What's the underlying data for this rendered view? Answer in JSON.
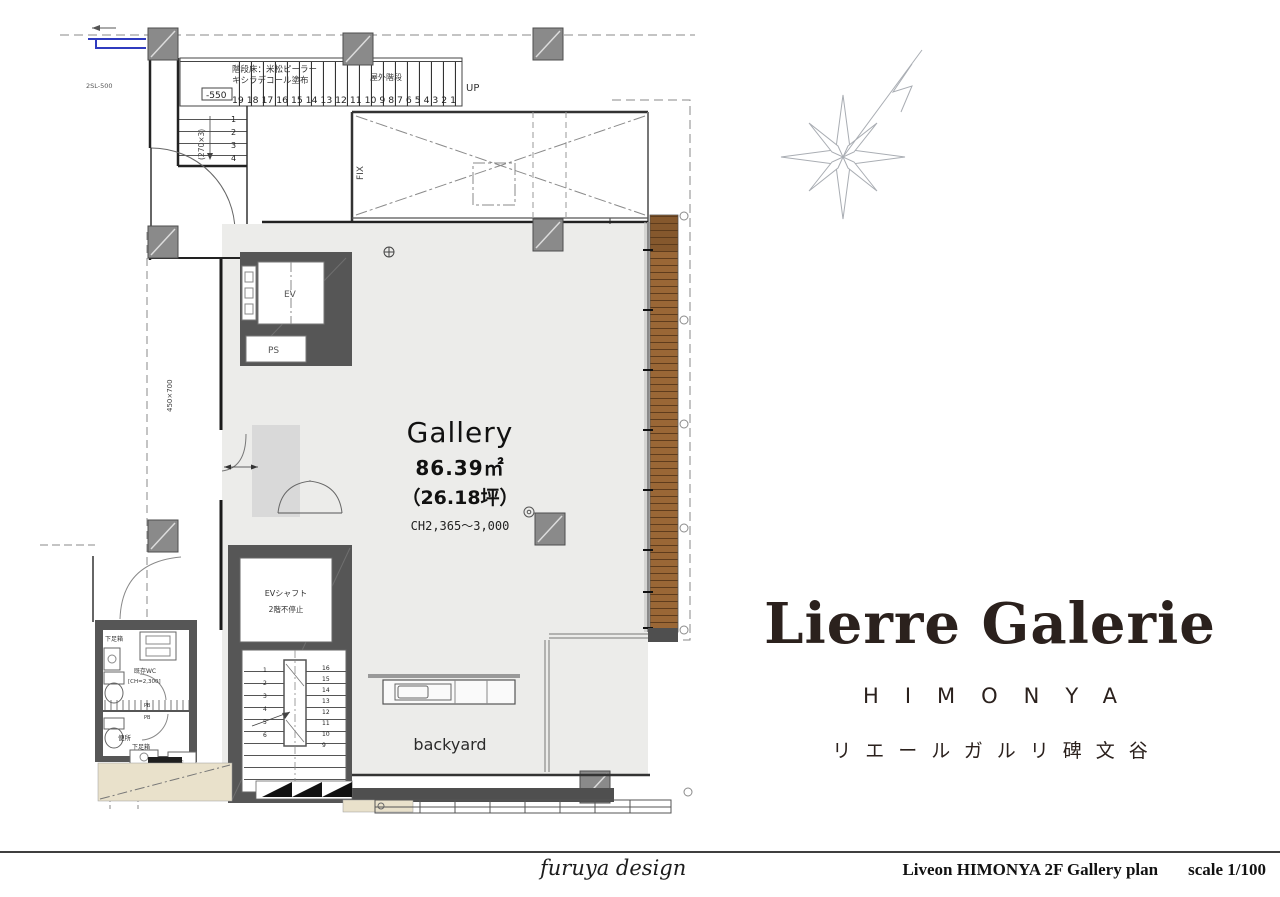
{
  "plan": {
    "room": {
      "title": "Gallery",
      "area_m2": "86.39㎡",
      "area_tsubo": "（26.18坪）",
      "ceiling_height": "CH2,365～3,000",
      "backyard": "backyard"
    },
    "labels": {
      "up": "UP",
      "fix": "FIX",
      "ev": "EV",
      "ps": "PS",
      "outdoor_stair": "屋外階段",
      "stair_note_1": "階段床：米松ピーラー",
      "stair_note_2": "キシラデコール塗布",
      "level": "-550",
      "dim_riser": "(270×3)",
      "dim_left": "450×700",
      "sl": "2SL-500",
      "ev_shaft_1": "EVシャフト",
      "ev_shaft_2": "2階不停止",
      "wc_upper": "既存WC",
      "wc_ch": "[CH=2,300]",
      "wc_lower": "便所",
      "shoe_box": "下足箱",
      "pb": "PB"
    },
    "outdoor_stair_numbers": "19 18 17 16 15 14 13 12 11 10 9 8 7 6 5 4 3 2 1",
    "landing_numbers": [
      "1",
      "2",
      "3",
      "4"
    ],
    "inner_stair_left": [
      "1",
      "2",
      "3",
      "4",
      "5",
      "6"
    ],
    "inner_stair_right": [
      "16",
      "15",
      "14",
      "13",
      "12",
      "11",
      "10",
      "9"
    ]
  },
  "branding": {
    "logo": "Lierre Galerie",
    "logo_sub": "HIMONYA",
    "logo_jp": "リエールガルリ碑文谷"
  },
  "footer": {
    "designer": "furuya design",
    "drawing_title": "Liveon HIMONYA 2F Gallery plan",
    "scale": "scale 1/100"
  },
  "colors": {
    "deck": "#9a6736",
    "deck_line": "#5f3c1c",
    "wall_dark": "#565656",
    "column": "#8a8a8a",
    "floor": "#ececea",
    "floor_entry": "#d9d9d9",
    "tan": "#e9e1cb",
    "blue": "#2f3bbf",
    "logo_ink": "#2b211d"
  }
}
